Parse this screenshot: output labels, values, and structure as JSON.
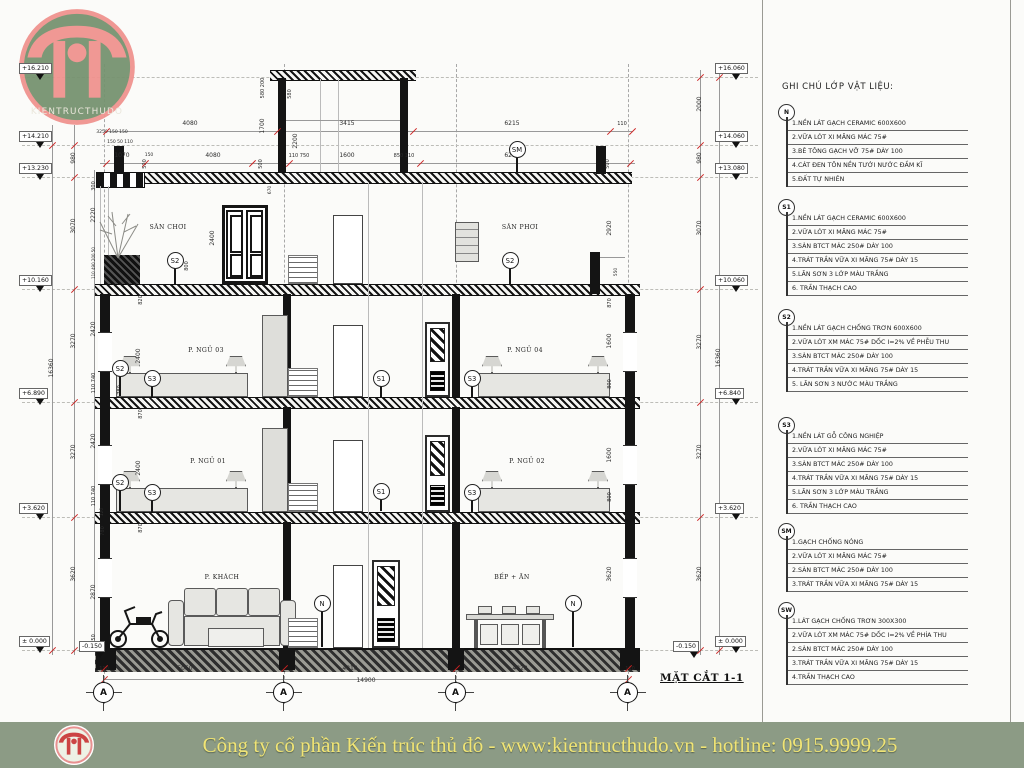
{
  "logo": {
    "text": "KIENTRUCTHUDO"
  },
  "footer": {
    "text": "Công ty cổ phần Kiến trúc thủ đô - www:kientructhudo.vn - hotline: 0915.9999.25"
  },
  "legend": {
    "title": "GHI CHÚ LỚP VẬT LIỆU:",
    "groups": [
      {
        "code": "N",
        "top": 104,
        "items": [
          "1.NỀN LÁT GẠCH CERAMIC 600X600",
          "2.VỮA LÓT XI MĂNG MÁC 75#",
          "3.BÊ TÔNG GẠCH VỠ  75# DÀY 100",
          "4.CÁT ĐEN TÔN NỀN TƯỚI NƯỚC ĐẦM KĨ",
          "5.ĐẤT TỰ NHIÊN"
        ]
      },
      {
        "code": "S1",
        "top": 199,
        "items": [
          "1.NỀN LÁT GẠCH CERAMIC 600X600",
          "2.VỮA LÓT XI MĂNG MÁC 75#",
          "3.SÀN BTCT MÁC 250# DÀY 100",
          "4.TRÁT TRẦN VỮA XI MĂNG 75# DÀY 15",
          "5.LĂN SƠN 3 LỚP MÀU TRẮNG",
          "6. TRẦN THẠCH CAO"
        ]
      },
      {
        "code": "S2",
        "top": 309,
        "items": [
          "1.NỀN LÁT GẠCH CHỐNG TRƠN 600X600",
          "2.VỮA LÓT XM MÁC 75# DỐC I=2% VỀ PHỄU THU",
          "3.SÀN BTCT MÁC 250# DÀY 100",
          "4.TRÁT TRẦN VỮA XI MĂNG 75# DÀY 15",
          "5. LĂN SƠN 3 NƯỚC MÀU TRẮNG"
        ]
      },
      {
        "code": "S3",
        "top": 417,
        "items": [
          "1.NỀN LÁT GỖ CÔNG NGHIỆP",
          "2.VỮA LÓT XI MĂNG MÁC 75#",
          "3.SÀN BTCT MÁC 250# DÀY 100",
          "4.TRÁT TRẦN VỮA XI MĂNG 75# DÀY 15",
          "5.LĂN SƠN 3 LỚP MÀU TRẮNG",
          "6. TRẦN THẠCH CAO"
        ]
      },
      {
        "code": "SM",
        "top": 523,
        "items": [
          "1.GẠCH CHỐNG NÓNG",
          "2.VỮA LÓT XI MĂNG MÁC 75#",
          "2.SÀN BTCT MÁC 250# DÀY 100",
          "3.TRÁT TRẦN VỮA XI MĂNG 75# DÀY 15"
        ]
      },
      {
        "code": "SW",
        "top": 602,
        "items": [
          "1.LÁT GẠCH CHỐNG TRƠN 300X300",
          "2.VỮA LÓT XM MÁC 75# DỐC I=2% VỀ PHÍA THU",
          "2.SÀN BTCT MÁC 250# DÀY 100",
          "3.TRÁT TRẦN VỮA XI MĂNG 75# DÀY 15",
          "4.TRẦN THẠCH CAO"
        ]
      }
    ]
  },
  "drawing": {
    "section_label": "MẶT CẮT 1-1",
    "rooms": [
      {
        "label": "SÂN CHƠI",
        "x": 168,
        "y": 228
      },
      {
        "label": "SÂN PHƠI",
        "x": 520,
        "y": 228
      },
      {
        "label": "P. NGỦ 03",
        "x": 206,
        "y": 351
      },
      {
        "label": "P. NGỦ 04",
        "x": 525,
        "y": 351
      },
      {
        "label": "P. NGỦ 01",
        "x": 208,
        "y": 462
      },
      {
        "label": "P. NGỦ 02",
        "x": 527,
        "y": 462
      },
      {
        "label": "P. KHÁCH",
        "x": 222,
        "y": 578
      },
      {
        "label": "BẾP + ĂN",
        "x": 512,
        "y": 578
      }
    ],
    "markers": [
      {
        "label": "SM",
        "x": 517,
        "y": 149,
        "stem": 16
      },
      {
        "label": "S2",
        "x": 175,
        "y": 260,
        "stem": 16
      },
      {
        "label": "S2",
        "x": 510,
        "y": 260,
        "stem": 16
      },
      {
        "label": "S2",
        "x": 120,
        "y": 368,
        "stem": 20
      },
      {
        "label": "S3",
        "x": 152,
        "y": 378,
        "stem": 11
      },
      {
        "label": "S1",
        "x": 381,
        "y": 378,
        "stem": 11
      },
      {
        "label": "S3",
        "x": 472,
        "y": 378,
        "stem": 11
      },
      {
        "label": "S2",
        "x": 120,
        "y": 482,
        "stem": 21
      },
      {
        "label": "S3",
        "x": 152,
        "y": 492,
        "stem": 12
      },
      {
        "label": "S1",
        "x": 381,
        "y": 491,
        "stem": 12
      },
      {
        "label": "S3",
        "x": 472,
        "y": 492,
        "stem": 12
      },
      {
        "label": "N",
        "x": 322,
        "y": 603,
        "stem": 36
      },
      {
        "label": "N",
        "x": 573,
        "y": 603,
        "stem": 36
      }
    ],
    "grid_bubbles": [
      {
        "label": "A",
        "x": 104,
        "y": 693
      },
      {
        "label": "A",
        "x": 284,
        "y": 693
      },
      {
        "label": "A",
        "x": 456,
        "y": 693
      },
      {
        "label": "A",
        "x": 628,
        "y": 693
      }
    ],
    "elevations": [
      {
        "t": "+16.210",
        "x": 40,
        "y": 77
      },
      {
        "t": "+14.210",
        "x": 40,
        "y": 145
      },
      {
        "t": "+13.230",
        "x": 40,
        "y": 177
      },
      {
        "t": "+10.160",
        "x": 40,
        "y": 289
      },
      {
        "t": "+6.890",
        "x": 40,
        "y": 402
      },
      {
        "t": "+3.620",
        "x": 40,
        "y": 517
      },
      {
        "t": "± 0.000",
        "x": 40,
        "y": 650
      },
      {
        "t": "-0.150",
        "x": 100,
        "y": 655
      },
      {
        "t": "+16.060",
        "x": 736,
        "y": 77
      },
      {
        "t": "+14.060",
        "x": 736,
        "y": 145
      },
      {
        "t": "+13.080",
        "x": 736,
        "y": 177
      },
      {
        "t": "+10.060",
        "x": 736,
        "y": 289
      },
      {
        "t": "+6.840",
        "x": 736,
        "y": 402
      },
      {
        "t": "+3.620",
        "x": 736,
        "y": 517
      },
      {
        "t": "± 0.000",
        "x": 736,
        "y": 650
      },
      {
        "t": "-0.150",
        "x": 694,
        "y": 655
      }
    ],
    "dim_labels": [
      {
        "t": "4080",
        "x": 190,
        "y": 124
      },
      {
        "t": "3415",
        "x": 347,
        "y": 124
      },
      {
        "t": "6215",
        "x": 512,
        "y": 124
      },
      {
        "t": "110",
        "x": 622,
        "y": 124,
        "fs": 5
      },
      {
        "t": "1070",
        "x": 122,
        "y": 156
      },
      {
        "t": "150",
        "x": 149,
        "y": 156,
        "fs": 4.5
      },
      {
        "t": "4080",
        "x": 213,
        "y": 156
      },
      {
        "t": "110 750",
        "x": 299,
        "y": 156,
        "fs": 5
      },
      {
        "t": "1600",
        "x": 347,
        "y": 156
      },
      {
        "t": "850 110",
        "x": 404,
        "y": 156,
        "fs": 5
      },
      {
        "t": "6210",
        "x": 512,
        "y": 156
      },
      {
        "t": "3250 150 150",
        "x": 112,
        "y": 133,
        "fs": 4.5
      },
      {
        "t": "150 50 110",
        "x": 120,
        "y": 143,
        "fs": 4.5
      },
      {
        "t": "580 200",
        "x": 263,
        "y": 88,
        "r": 1,
        "fs": 5
      },
      {
        "t": "580",
        "x": 290,
        "y": 94,
        "r": 1,
        "fs": 5
      },
      {
        "t": "1700",
        "x": 263,
        "y": 126,
        "r": 1
      },
      {
        "t": "2200",
        "x": 296,
        "y": 141,
        "r": 1
      },
      {
        "t": "500",
        "x": 145,
        "y": 164,
        "r": 1,
        "fs": 5
      },
      {
        "t": "500",
        "x": 261,
        "y": 164,
        "r": 1,
        "fs": 5
      },
      {
        "t": "500",
        "x": 608,
        "y": 164,
        "r": 1,
        "fs": 5
      },
      {
        "t": "670",
        "x": 271,
        "y": 190,
        "r": 1,
        "fs": 4.5
      },
      {
        "t": "16360",
        "x": 52,
        "y": 368,
        "r": 1
      },
      {
        "t": "980",
        "x": 74,
        "y": 158,
        "r": 1
      },
      {
        "t": "3070",
        "x": 74,
        "y": 226,
        "r": 1
      },
      {
        "t": "3270",
        "x": 74,
        "y": 341,
        "r": 1
      },
      {
        "t": "3270",
        "x": 74,
        "y": 452,
        "r": 1
      },
      {
        "t": "3620",
        "x": 74,
        "y": 574,
        "r": 1
      },
      {
        "t": "300",
        "x": 94,
        "y": 186,
        "r": 1,
        "fs": 5
      },
      {
        "t": "2220",
        "x": 94,
        "y": 215,
        "r": 1
      },
      {
        "t": "110 490 200 50",
        "x": 94,
        "y": 263,
        "r": 1,
        "fs": 4
      },
      {
        "t": "2420",
        "x": 94,
        "y": 329,
        "r": 1
      },
      {
        "t": "110 740",
        "x": 94,
        "y": 383,
        "r": 1,
        "fs": 5
      },
      {
        "t": "2420",
        "x": 94,
        "y": 441,
        "r": 1
      },
      {
        "t": "110 740",
        "x": 94,
        "y": 496,
        "r": 1,
        "fs": 5
      },
      {
        "t": "2870",
        "x": 94,
        "y": 592,
        "r": 1
      },
      {
        "t": "150",
        "x": 94,
        "y": 639,
        "r": 1,
        "fs": 5
      },
      {
        "t": "120",
        "x": 103,
        "y": 512,
        "r": 1,
        "fs": 4.5
      },
      {
        "t": "780",
        "x": 120,
        "y": 390,
        "r": 1,
        "fs": 5
      },
      {
        "t": "780",
        "x": 103,
        "y": 531,
        "r": 1,
        "fs": 5
      },
      {
        "t": "820",
        "x": 141,
        "y": 300,
        "r": 1,
        "fs": 5
      },
      {
        "t": "2400",
        "x": 213,
        "y": 238,
        "r": 1
      },
      {
        "t": "2400",
        "x": 139,
        "y": 356,
        "r": 1
      },
      {
        "t": "870",
        "x": 141,
        "y": 414,
        "r": 1,
        "fs": 5
      },
      {
        "t": "2400",
        "x": 139,
        "y": 468,
        "r": 1
      },
      {
        "t": "870",
        "x": 141,
        "y": 528,
        "r": 1,
        "fs": 5
      },
      {
        "t": "800",
        "x": 187,
        "y": 266,
        "r": 1,
        "fs": 5
      },
      {
        "t": "2920",
        "x": 610,
        "y": 228,
        "r": 1
      },
      {
        "t": "550",
        "x": 617,
        "y": 272,
        "r": 1,
        "fs": 4.5
      },
      {
        "t": "870",
        "x": 610,
        "y": 303,
        "r": 1,
        "fs": 5
      },
      {
        "t": "1600",
        "x": 610,
        "y": 341,
        "r": 1
      },
      {
        "t": "800",
        "x": 610,
        "y": 384,
        "r": 1,
        "fs": 5
      },
      {
        "t": "1600",
        "x": 610,
        "y": 455,
        "r": 1
      },
      {
        "t": "800",
        "x": 610,
        "y": 497,
        "r": 1,
        "fs": 5
      },
      {
        "t": "3620",
        "x": 610,
        "y": 574,
        "r": 1
      },
      {
        "t": "2000",
        "x": 700,
        "y": 104,
        "r": 1
      },
      {
        "t": "980",
        "x": 700,
        "y": 158,
        "r": 1
      },
      {
        "t": "3070",
        "x": 700,
        "y": 228,
        "r": 1
      },
      {
        "t": "3270",
        "x": 700,
        "y": 342,
        "r": 1
      },
      {
        "t": "3270",
        "x": 700,
        "y": 452,
        "r": 1
      },
      {
        "t": "3620",
        "x": 700,
        "y": 574,
        "r": 1
      },
      {
        "t": "16360",
        "x": 719,
        "y": 358,
        "r": 1
      },
      {
        "t": "110",
        "x": 104,
        "y": 669,
        "fs": 5
      },
      {
        "t": "5050",
        "x": 185,
        "y": 669
      },
      {
        "t": "4810",
        "x": 350,
        "y": 669
      },
      {
        "t": "4820",
        "x": 520,
        "y": 669
      },
      {
        "t": "110",
        "x": 630,
        "y": 669,
        "fs": 5
      },
      {
        "t": "14900",
        "x": 366,
        "y": 681
      }
    ],
    "ticks": [
      {
        "x": 106,
        "y": 131
      },
      {
        "x": 277,
        "y": 131
      },
      {
        "x": 413,
        "y": 131
      },
      {
        "x": 610,
        "y": 131
      },
      {
        "x": 632,
        "y": 131
      },
      {
        "x": 106,
        "y": 163
      },
      {
        "x": 145,
        "y": 163
      },
      {
        "x": 252,
        "y": 163
      },
      {
        "x": 289,
        "y": 163
      },
      {
        "x": 420,
        "y": 163
      },
      {
        "x": 630,
        "y": 163
      },
      {
        "x": 104,
        "y": 668
      },
      {
        "x": 284,
        "y": 668
      },
      {
        "x": 456,
        "y": 668
      },
      {
        "x": 628,
        "y": 668
      },
      {
        "x": 104,
        "y": 679
      },
      {
        "x": 628,
        "y": 679
      },
      {
        "x": 74,
        "y": 145
      },
      {
        "x": 74,
        "y": 177
      },
      {
        "x": 74,
        "y": 289
      },
      {
        "x": 74,
        "y": 402
      },
      {
        "x": 74,
        "y": 517
      },
      {
        "x": 74,
        "y": 650
      },
      {
        "x": 52,
        "y": 145
      },
      {
        "x": 52,
        "y": 650
      },
      {
        "x": 700,
        "y": 77
      },
      {
        "x": 700,
        "y": 145
      },
      {
        "x": 700,
        "y": 177
      },
      {
        "x": 700,
        "y": 289
      },
      {
        "x": 700,
        "y": 402
      },
      {
        "x": 700,
        "y": 517
      },
      {
        "x": 700,
        "y": 650
      },
      {
        "x": 719,
        "y": 77
      },
      {
        "x": 719,
        "y": 650
      }
    ]
  }
}
